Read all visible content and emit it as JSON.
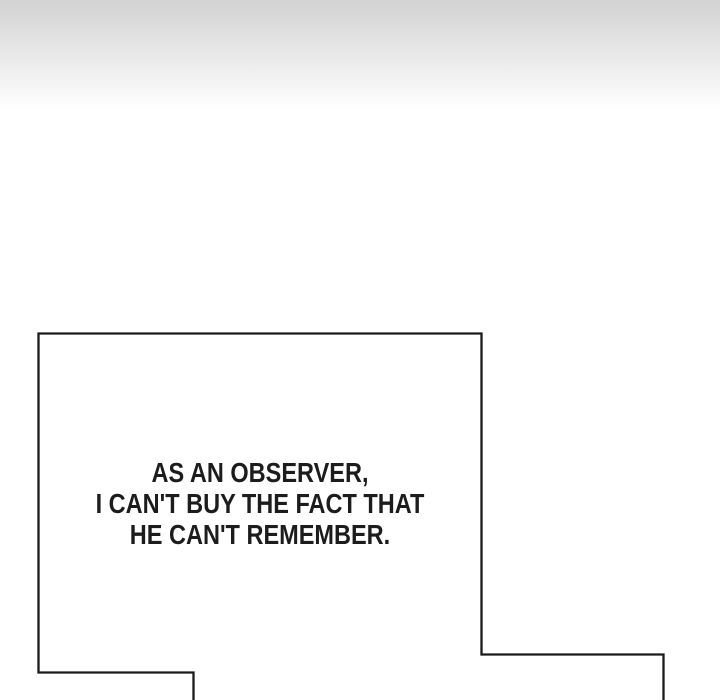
{
  "colors": {
    "page_background": "#ffffff",
    "gradient_top": "#d2d2d2",
    "panel_outline": "#1a1a1a",
    "text": "#1c1c1c"
  },
  "speech_bubble": {
    "lines": [
      "AS AN OBSERVER,",
      "I CAN'T BUY THE FACT THAT",
      "HE CAN'T REMEMBER."
    ]
  }
}
